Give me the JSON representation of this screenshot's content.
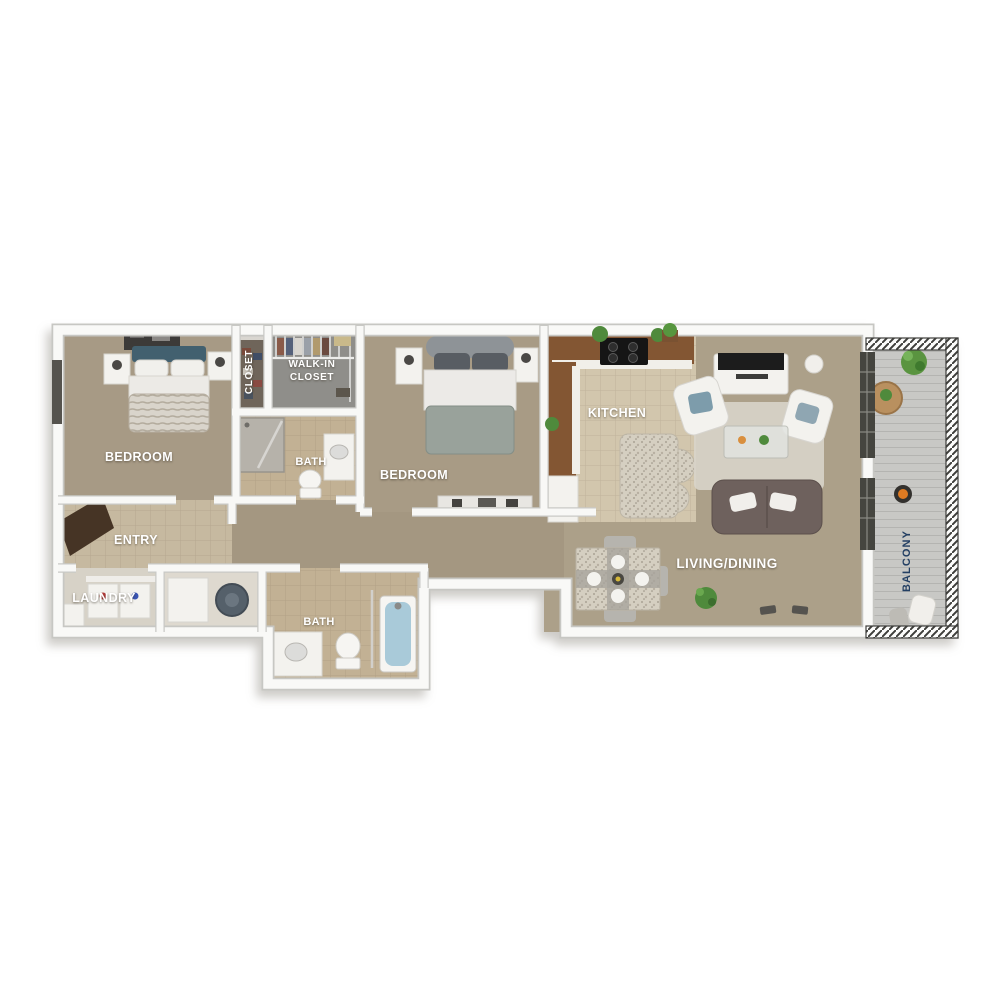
{
  "page": {
    "background_color": "#ffffff",
    "description": "3D top-down rendering of a two bedroom, two bath apartment floor plan with balcony"
  },
  "floorplan": {
    "view": "top-down 3D render",
    "default_label_color": "#ffffff",
    "rooms": [
      {
        "id": "bedroom-1",
        "label": "BEDROOM",
        "floor": "carpet",
        "floor_color": "#a79a85",
        "furniture": [
          "dresser",
          "queen-bed",
          "nightstand",
          "nightstand"
        ]
      },
      {
        "id": "closet",
        "label": "CLOSET",
        "label_rotation_deg": -90,
        "floor_color": "#6f655a",
        "furniture": [
          "shelves"
        ]
      },
      {
        "id": "walk-in-closet",
        "label": "WALK-IN CLOSET",
        "label_line1": "WALK-IN",
        "label_line2": "CLOSET",
        "floor_color": "#8f8e8a",
        "furniture": [
          "wire-shelving",
          "hanging-clothes",
          "storage-box"
        ]
      },
      {
        "id": "bath-1",
        "label": "BATH",
        "floor": "tile",
        "floor_color": "#c2b194",
        "furniture": [
          "shower",
          "vanity-sink",
          "toilet"
        ]
      },
      {
        "id": "bedroom-2",
        "label": "BEDROOM",
        "floor": "carpet",
        "floor_color": "#a89b85",
        "furniture": [
          "queen-bed",
          "nightstand",
          "nightstand",
          "dresser"
        ]
      },
      {
        "id": "kitchen",
        "label": "KITCHEN",
        "floor": "tile",
        "floor_color": "#d2c6ad",
        "furniture": [
          "wood-cabinets",
          "cooktop-stove",
          "refrigerator",
          "granite-island",
          "plants"
        ]
      },
      {
        "id": "living-dining",
        "label": "LIVING/DINING",
        "floor": "carpet",
        "floor_color": "#aca089",
        "furniture": [
          "tv-console",
          "tv",
          "armchair",
          "armchair",
          "coffee-table",
          "area-rug",
          "tufted-sofa",
          "dining-table",
          "dining-chairs",
          "floor-plant",
          "sliding-glass-doors"
        ]
      },
      {
        "id": "entry",
        "label": "ENTRY",
        "floor": "tile",
        "floor_color": "#c6b9a0",
        "furniture": [
          "entry-door"
        ]
      },
      {
        "id": "laundry",
        "label": "LAUNDRY",
        "floor_color": "#d7d2c7",
        "furniture": [
          "washer",
          "dryer",
          "shelf"
        ]
      },
      {
        "id": "utility-closet",
        "floor_color": "#ded9cf",
        "furniture": [
          "storage-box",
          "water-heater"
        ]
      },
      {
        "id": "bath-2",
        "label": "BATH",
        "floor": "tile",
        "floor_color": "#c2b194",
        "furniture": [
          "vanity-sink",
          "toilet",
          "bathtub"
        ]
      },
      {
        "id": "balcony",
        "label": "BALCONY",
        "label_rotation_deg": -90,
        "label_color": "#233f63",
        "floor": "deck",
        "floor_color": "#c8c8c5",
        "furniture": [
          "round-table",
          "potted-plant",
          "shrub",
          "fire-pit",
          "patio-chairs",
          "railing"
        ]
      }
    ],
    "colors": {
      "wall": "#f9f9f7",
      "wall_edge": "#c7c7c3",
      "carpet": "#a89b85",
      "tile": "#cfc3aa",
      "cabinet_wood": "#835633",
      "sofa": "#6e615d",
      "accent_pillow": "#7d9cab",
      "bed1_headboard": "#42606f",
      "bathtub": "#a9cad9",
      "railing": "#3e3e3b",
      "plant": "#4f8a3c",
      "balcony_label": "#233f63",
      "entry_door": "#463425"
    }
  }
}
